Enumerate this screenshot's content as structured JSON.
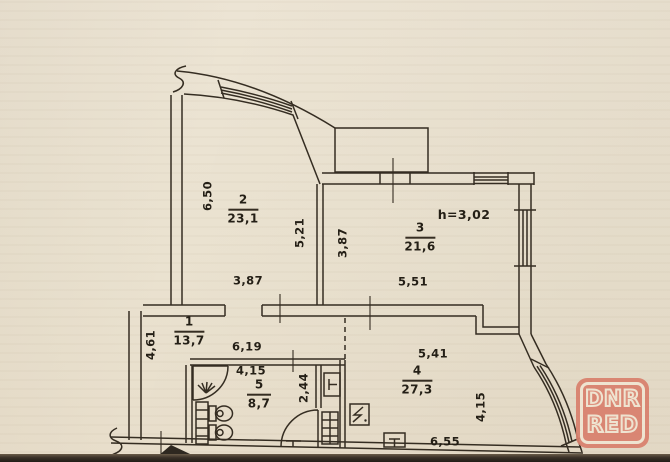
{
  "plan": {
    "rooms": [
      {
        "number": "2",
        "area": "23,1"
      },
      {
        "number": "3",
        "area": "21,6"
      },
      {
        "number": "1",
        "area": "13,7"
      },
      {
        "number": "5",
        "area": "8,7"
      },
      {
        "number": "4",
        "area": "27,3"
      }
    ],
    "dimensions": [
      "6,50",
      "5,21",
      "3,87",
      "3,87",
      "5,51",
      "h=3,02",
      "4,61",
      "6,19",
      "4,15",
      "2,44",
      "5,41",
      "4,15",
      "6,55"
    ]
  },
  "watermark": {
    "line1": "DNR",
    "line2": "RED",
    "badge_color": "#d9806d",
    "outline_color": "#f0e5d2"
  },
  "colors": {
    "paper": "#eae2d0",
    "ink": "#352d22"
  }
}
